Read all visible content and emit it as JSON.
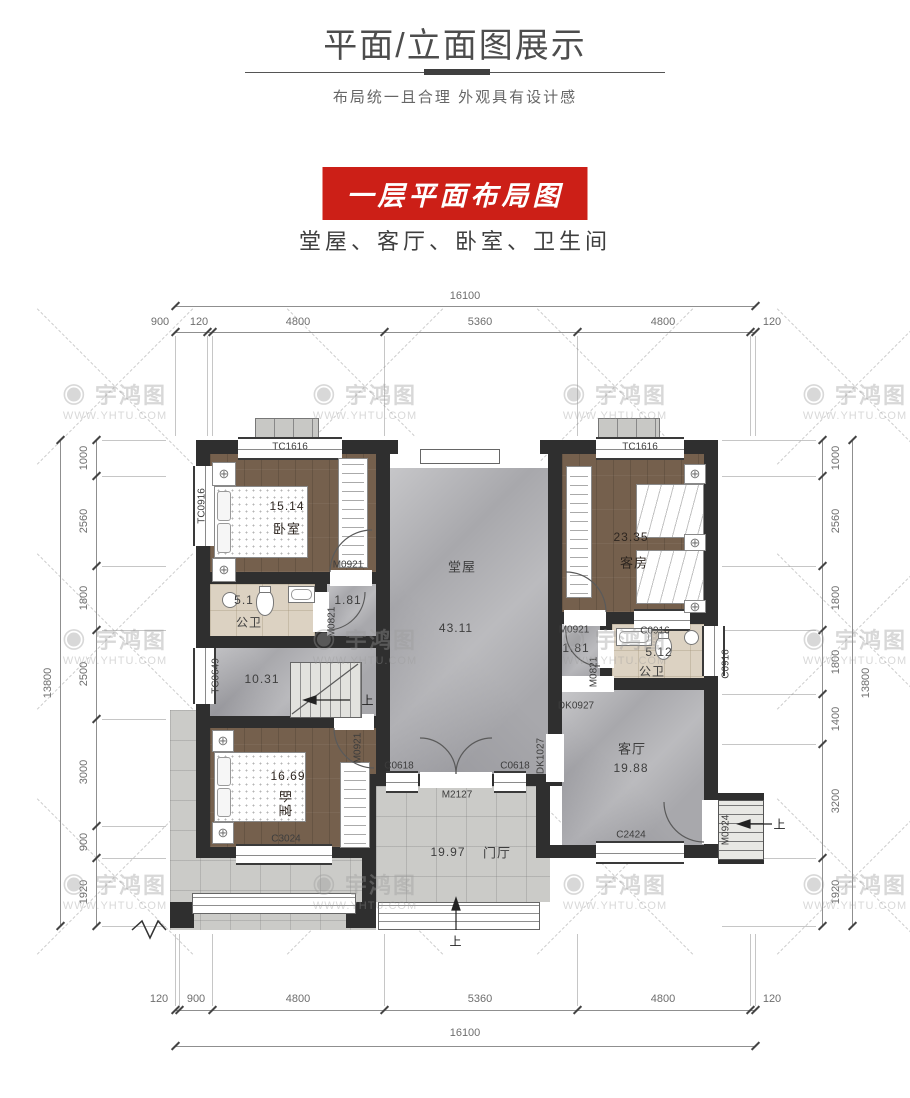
{
  "header": {
    "title": "平面/立面图展示",
    "subtitle": "布局统一且合理 外观具有设计感",
    "badge": "一层平面布局图",
    "rooms_line": "堂屋、客厅、卧室、卫生间"
  },
  "watermark": {
    "logo_glyph": "◉",
    "brand": "宇鸿图",
    "url": "WWW.YHTU.COM"
  },
  "dims": {
    "top": {
      "total": "16100",
      "segments": [
        "900",
        "120",
        "4800",
        "5360",
        "4800",
        "120"
      ]
    },
    "bottom": {
      "total": "16100",
      "segments": [
        "120",
        "900",
        "4800",
        "5360",
        "4800",
        "120"
      ]
    },
    "left": {
      "total": "13800",
      "segments": [
        "1000",
        "2560",
        "1800",
        "2500",
        "3000",
        "900",
        "1920"
      ]
    },
    "right": {
      "total": "13800",
      "segments": [
        "1000",
        "2560",
        "1800",
        "1800",
        "1400",
        "3200",
        "1920"
      ]
    }
  },
  "plan": {
    "bed_tl": {
      "name": "卧室",
      "area": "15.14"
    },
    "bath_l": {
      "name": "公卫",
      "area": "5.1"
    },
    "corr_l": {
      "area": "1.81"
    },
    "stair_hall": {
      "area": "10.31"
    },
    "hall": {
      "name": "堂屋",
      "area": "43.11"
    },
    "guest": {
      "name": "客房",
      "area": "23.35"
    },
    "bath_r": {
      "name": "公卫",
      "area": "5.12"
    },
    "corr_r": {
      "area": "1.81"
    },
    "living": {
      "name": "客厅",
      "area": "19.88"
    },
    "bed_bl": {
      "name": "卧室",
      "area": "16.69"
    },
    "foyer": {
      "name": "门厅",
      "area": "19.97"
    },
    "up": "上",
    "codes": {
      "tc1616": "TC1616",
      "tc0916": "TC0916",
      "tc0649": "TC0649",
      "m0921": "M0921",
      "m0821": "M0821",
      "c0916": "C0916",
      "m2127": "M2127",
      "c0618": "C0618",
      "dk1027": "DK1027",
      "dk0927": "DK0927",
      "c2424": "C2424",
      "c3024": "C3024",
      "m0924": "M0924"
    }
  }
}
